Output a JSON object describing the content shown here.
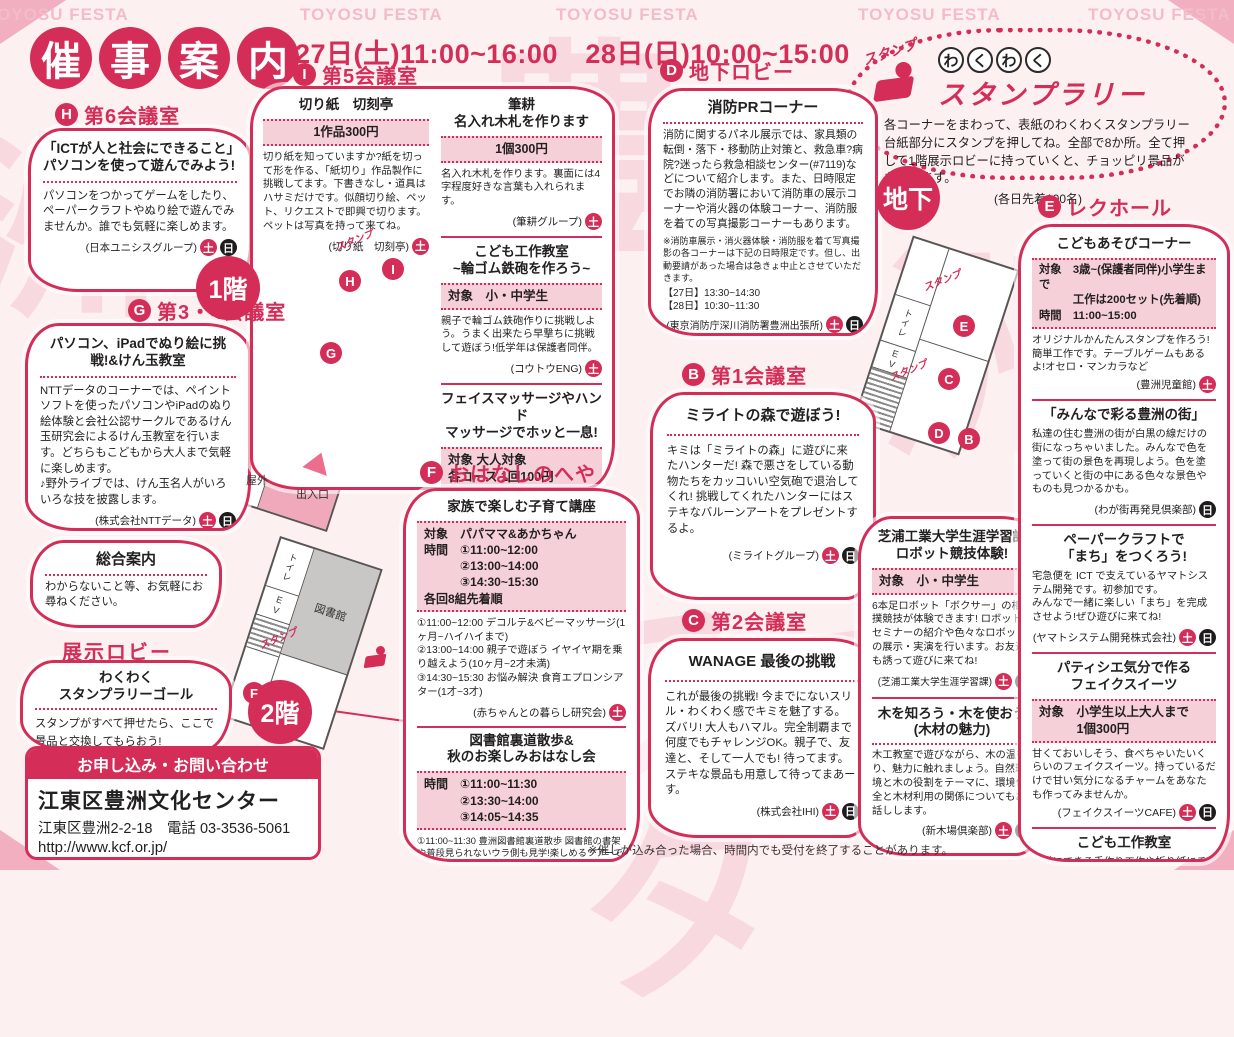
{
  "colors": {
    "accent": "#d42d57",
    "pink_box": "#f6d0d9",
    "background": "#fdf0f1",
    "sun_badge": "#1d1b1b",
    "map_gray": "#c9c7c6"
  },
  "badges": {
    "sat": "土",
    "sun": "日"
  },
  "page": {
    "watermark": "TOYOSU FESTA",
    "watermark_chars": [
      "豊",
      "洲",
      "洲",
      "フェスタ"
    ],
    "title_chars": [
      "催",
      "事",
      "案",
      "内"
    ],
    "dates": "27日(土)11:00~16:00　28日(日)10:00~15:00",
    "bottom_note": "※催しが込み合った場合、時間内でも受付を終了することがあります。"
  },
  "stamp_rally": {
    "stamp_label": "スタンプ",
    "wakuwaku_chars": [
      "わ",
      "く",
      "わ",
      "く"
    ],
    "title": "スタンプラリー",
    "body": "各コーナーをまわって、表紙のわくわくスタンプラリー台紙部分にスタンプを押してね。全部で8か所。全て押して1階展示ロビーに持っていくと、チョッピリ景品がもらえます。",
    "note": "(各日先着100名)"
  },
  "contact": {
    "header": "お申し込み・お問い合わせ",
    "name": "江東区豊洲文化センター",
    "address": "江東区豊洲2-2-18　電話 03-3536-5061",
    "url": "http://www.kcf.or.jp/",
    "hours": "開館時間 9:00~22:00(第2・4月曜日休館)"
  },
  "maps": {
    "f1": {
      "label": "1階",
      "lib_office": "図書館事務室",
      "office": "事　務　室",
      "toilet": "トイレ",
      "ev": "EV",
      "outside": "屋外",
      "entrance": "出入口",
      "stamp": "スタンプ",
      "marker_h": "H",
      "marker_i": "I",
      "marker_g": "G"
    },
    "f2": {
      "label": "2階",
      "library": "図書館",
      "toilet": "トイレ",
      "ev": "EV",
      "stamp": "スタンプ",
      "marker_f": "F"
    },
    "b1": {
      "label": "地下",
      "toilet": "トイレ",
      "ev": "EV",
      "stamp": "スタンプ",
      "marker_e": "E",
      "marker_c": "C",
      "marker_d": "D",
      "marker_b": "B"
    }
  },
  "sections": {
    "h6": {
      "letter": "H",
      "room": "第6会議室",
      "title": "「ICTが人と社会にできること」パソコンを使って遊んでみよう!",
      "body": "パソコンをつかってゲームをしたり、ペーパークラフトやぬり絵で遊んでみませんか。誰でも気軽に楽しめます。",
      "credit": "(日本ユニシスグループ)"
    },
    "g34": {
      "letter": "G",
      "room": "第3・4会議室",
      "title": "パソコン、iPadでぬり絵に挑戦!&けん玉教室",
      "body": "NTTデータのコーナーでは、ペイントソフトを使ったパソコンやiPadのぬり絵体験と会社公認サークルであるけん玉研究会によるけん玉教室を行います。どちらもこどもから大人まで気軽に楽しめます。\n♪野外ライブでは、けん玉名人がいろいろな技を披露します。",
      "credit": "(株式会社NTTデータ)"
    },
    "info_desk": {
      "title": "総合案内",
      "body": "わからないこと等、お気軽にお尋ねください。"
    },
    "lobby": {
      "label": "展示ロビー",
      "title": "わくわく\nスタンプラリーゴール",
      "body": "スタンプがすべて押せたら、ここで景品と交換してもらおう!"
    },
    "i5": {
      "letter": "I",
      "room": "第5会議室",
      "kirigami": {
        "title": "切り紙　切刻亭",
        "price": "1作品300円",
        "body": "切り紙を知っていますか?紙を切って形を作る、「紙切り」作品製作に挑戦してます。下書きなし・道具はハサミだけです。似顔切り絵、ペット、リクエストで即興で切ります。ペットは写真を持って来てね。",
        "credit": "(切り紙　切刻亭)"
      },
      "hikkou": {
        "title": "筆耕\n名入れ木札を作ります",
        "price": "1個300円",
        "body": "名入れ木札を作ります。裏面には4字程度好きな言葉も入れられます。",
        "credit": "(筆耕グループ)"
      },
      "kousaku": {
        "title": "こども工作教室\n~輪ゴム鉄砲を作ろう~",
        "target": "対象　小・中学生",
        "body": "親子で輪ゴム鉄砲作りに挑戦しよう。うまく出来たら早撃ちに挑戦して遊ぼう!低学年は保護者同伴。",
        "credit": "(コウトウENG)"
      },
      "massage": {
        "title": "フェイスマッサージやハンド\nマッサージでホッと一息!",
        "info": "対象 大人対象\n各コース 1回100円",
        "body": "秋の休日をフェイスマッサージやハンドマッサージを受けてみませんか!心を癒すリンパマッサージとナチュラルメイクで外見だけでなく心までも明るく元気になっていただけます。(メイクセラピーとは化粧療法です。リラックス効果があります。)",
        "credit": "(メイクセラピー和)"
      }
    },
    "f_room": {
      "letter": "F",
      "room": "おはなしのへや",
      "kosodate": {
        "title": "家族で楽しむ子育て講座",
        "info": "対象　パパママ&あかちゃん\n時間　①11:00~12:00\n　　　②13:00~14:00\n　　　③14:30~15:30\n各回8組先着順",
        "body": "①11:00~12:00 デコルテ&ベビーマッサージ(1ヶ月~ハイハイまで)\n②13:00~14:00 親子で遊ぼう イヤイヤ期を乗り越えよう(10ヶ月~2才未満)\n③14:30~15:30 お悩み解決 食育エプロンシアター(1才~3才)",
        "credit": "(赤ちゃんとの暮らし研究会)"
      },
      "library": {
        "title": "図書館裏道散歩&\n秋のお楽しみおはなし会",
        "info": "時間　①11:00~11:30\n　　　②13:30~14:00\n　　　③14:05~14:35",
        "body": "①11:00~11:30 豊洲図書館裏道散歩 図書館の書架や普段見られないウラ側も見学!楽しめるツアーです。粗品贈呈。親子5組先着順(幼児以上とその保護者での参加可。)\n②13:30~14:00 第1部「小さな人形劇」定員:こども20名 先着順(親子同伴可)\n③14:05~14:35 第2部「秋」をテーマにしたこども向けの絵本の読み聞かせなど 定員:こども20名先着順(親子同伴可)",
        "credit": "(豊洲図書館)"
      }
    },
    "d_lobby": {
      "letter": "D",
      "room": "地下ロビー",
      "fire": {
        "title": "消防PRコーナー",
        "body": "消防に関するパネル展示では、家具類の転倒・落下・移動防止対策と、救急車?病院?迷ったら救急相談センター(#7119)などについて紹介します。また、日時限定でお隣の消防署において消防車の展示コーナーや消火器の体験コーナー、消防服を着ての写真撮影コーナーもあります。",
        "note": "※消防車展示・消火器体験・消防服を着て写真撮影の各コーナーは下記の日時限定です。但し、出動要請があった場合は急きょ中止とさせていただきます。",
        "times": "【27日】13:30~14:30\n【28日】10:30~11:30",
        "credit": "(東京消防庁深川消防署豊洲出張所)"
      }
    },
    "b1": {
      "letter": "B",
      "room": "第1会議室",
      "mirait": {
        "title": "ミライトの森で遊ぼう!",
        "body": "キミは「ミライトの森」に遊びに来たハンターだ! 森で悪さをしている動物たちをカッコいい空気砲で退治してくれ! 挑戦してくれたハンターにはステキなバルーンアートをプレゼントするよ。",
        "credit": "(ミライトグループ)"
      }
    },
    "c2": {
      "letter": "C",
      "room": "第2会議室",
      "wanage": {
        "title": "WANAGE 最後の挑戦",
        "body": "これが最後の挑戦! 今までにないスリル・わくわく感でキミを魅了する。\nズバリ! 大人もハマル。完全制覇まで何度でもチャレンジOK。親子で、友達と、そして一人でも! 待ってます。ステキな景品も用意して待ってまあーす。",
        "credit": "(株式会社IHI)"
      }
    },
    "shibaura": {
      "title": "芝浦工業大学生涯学習課\nロボット競技体験!",
      "target": "対象　小・中学生",
      "body": "6本足ロボット「ボクサー」の相撲競技が体験できます! ロボットセミナーの紹介や色々なロボットの展示・実演を行います。お友達も誘って遊びに来てね!",
      "credit": "(芝浦工業大学生涯学習課)"
    },
    "wood": {
      "title": "木を知ろう・木を使おう\n(木材の魅力)",
      "body": "木工教室で遊びながら、木の温もり、魅力に触れましょう。自然環境と木の役割をテーマに、環境保全と木材利用の関係についてもお話しします。",
      "credit": "(新木場倶楽部)"
    },
    "e_hall": {
      "letter": "E",
      "room": "レクホール",
      "asobi": {
        "title": "こどもあそびコーナー",
        "info": "対象　3歳~(保護者同伴)小学生まで\n　　　工作は200セット(先着順)\n時間　11:00~15:00",
        "body": "オリジナルかんたんスタンプを作ろう!簡単工作です。テーブルゲームもあるよ!オセロ・マンカラなど",
        "credit": "(豊洲児童館)"
      },
      "machi": {
        "title": "「みんなで彩る豊洲の街」",
        "body": "私達の住む豊洲の街が白黒の線だけの街になっちゃいました。みんなで色を塗って街の景色を再現しよう。色を塗っていくと街の中にある色々な景色やものも見つかるかも。",
        "credit": "(わが街再発見倶楽部)"
      },
      "papercraft": {
        "title": "ペーパークラフトで\n「まち」をつくろう!",
        "body": "宅急便を ICT で支えているヤマトシステム開発です。初参加です。\nみんなで一緒に楽しい「まち」を完成させよう!ぜひ遊びに来てね!",
        "credit": "(ヤマトシステム開発株式会社)"
      },
      "sweets": {
        "title": "パティシエ気分で作る\nフェイクスイーツ",
        "info": "対象　小学生以上大人まで\n　　　1個300円",
        "body": "甘くておいしそう、食べちゃいたいくらいのフェイクスイーツ。持っているだけで甘い気分になるチャームをあなたも作ってみませんか。",
        "credit": "(フェイクスイーツCAFE)"
      },
      "kousaku": {
        "title": "こども工作教室",
        "body": "簡単にできる手作り工作や折り紙にチャレンジ! 小さい子から出来るよ。おうちの人と一緒にね!",
        "credit": "(江東区少年団体江南連合会)"
      }
    }
  }
}
